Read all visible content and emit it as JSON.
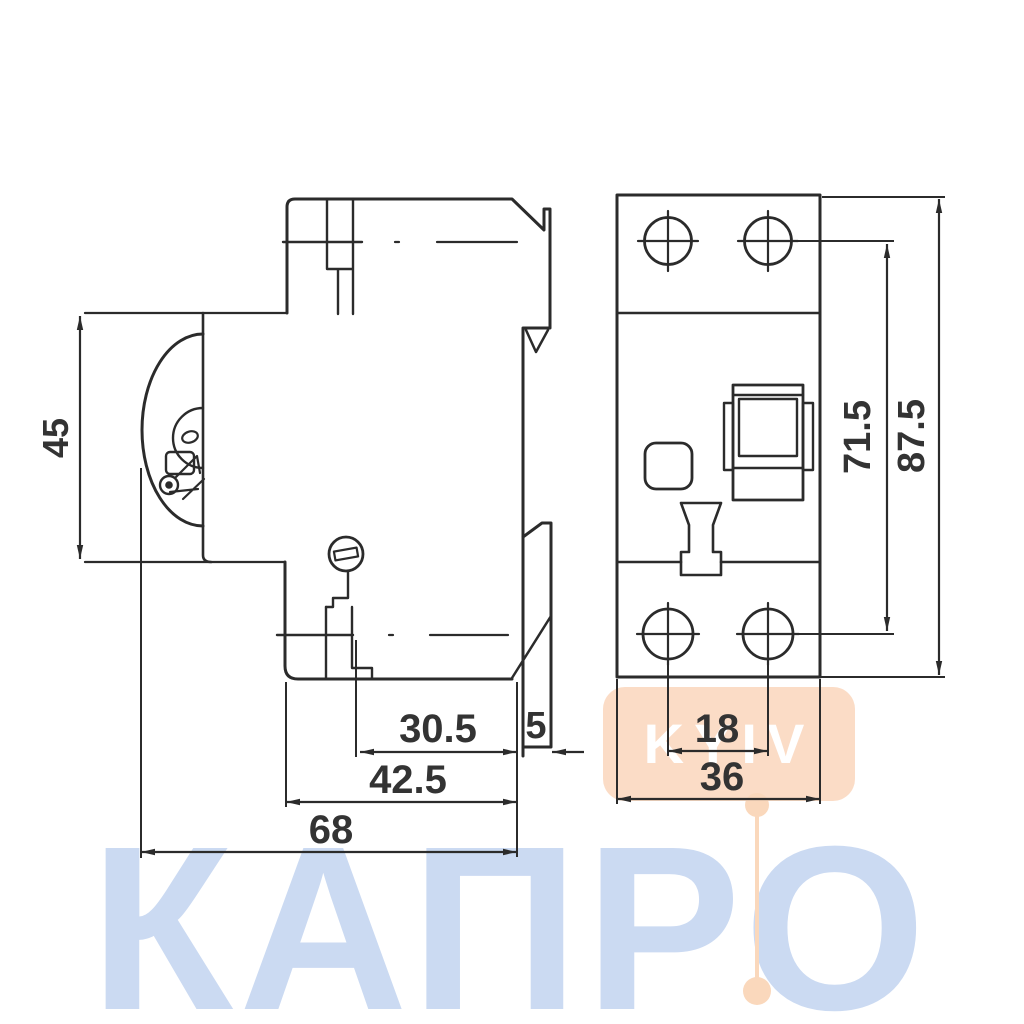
{
  "drawing": {
    "title": "RCD circuit breaker dimensional drawing",
    "side_view": {
      "height_front": "45",
      "depth_total": "68",
      "depth_body": "42.5",
      "depth_rear": "30.5",
      "din_clip_depth": "5"
    },
    "front_view": {
      "terminal_screw_span": "71.5",
      "height_total": "87.5",
      "hole_pitch": "18",
      "width_total": "36"
    },
    "watermark": {
      "brand": "КАПРО",
      "badge": "KYIV"
    },
    "colors": {
      "line": "#2b2b2b",
      "label": "#333333",
      "watermark_blue": "#cbdaf2",
      "watermark_peach": "#fbdcc6",
      "watermark_badge_text": "#ffffff",
      "background": "#ffffff"
    }
  }
}
